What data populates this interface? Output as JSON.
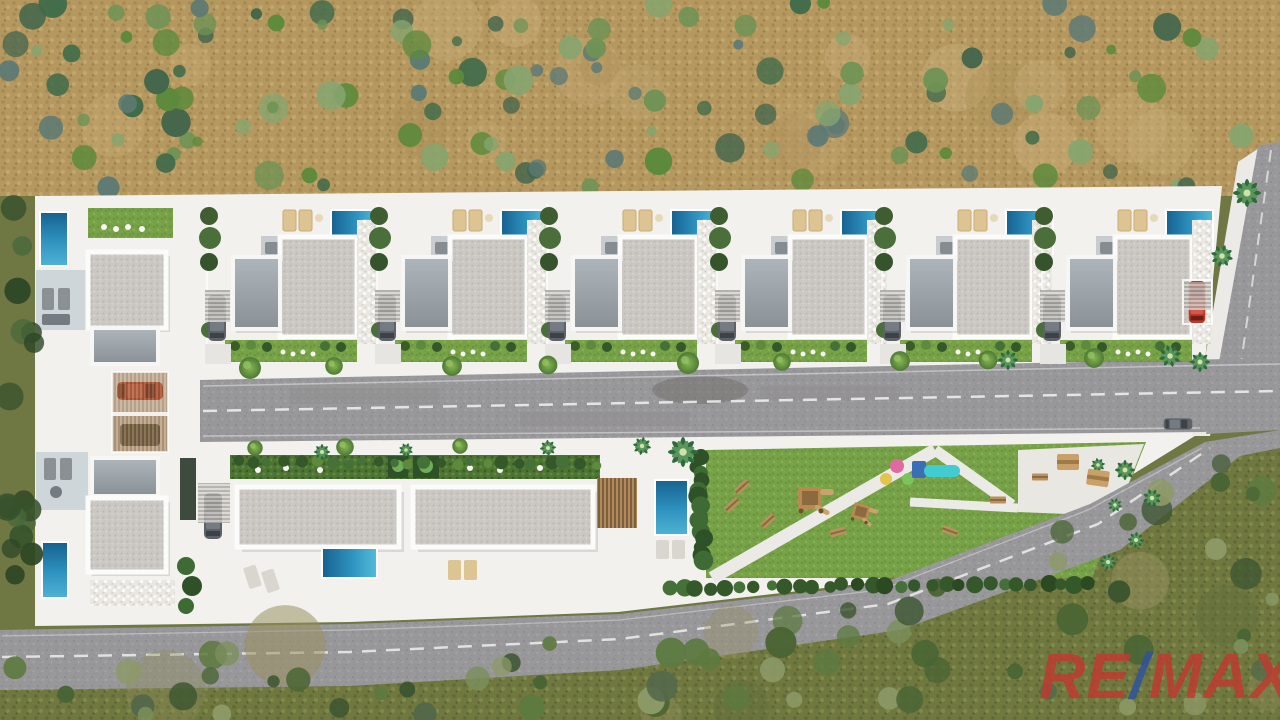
{
  "watermark": {
    "re": "RE",
    "slash": "/",
    "max": "MAX"
  },
  "palette": {
    "remax_red": "#c0392f",
    "remax_blue": "#2c53a0",
    "dry_field_tan": "#b4985f",
    "olive_scrub": "#6f7743",
    "platform_white": "#f2f1ee",
    "asphalt_grey": "#98979a",
    "pool_blue_deep": "#16618f",
    "pool_blue_light": "#55bcd9",
    "roof_speckle_grey": "#cbc8c3",
    "park_grass_green": "#76a147",
    "hedge_green": "#4d7433",
    "red_car": "#c0392b",
    "slide_cyan": "#41ccd1"
  },
  "scene": {
    "description": "Aerial 3D render of a gated villa development: two rows of white villas with private pools, central street, communal park with playground, surrounded by dry scrubland",
    "top_row_villas": {
      "count": 6,
      "x_positions": [
        205,
        375,
        545,
        715,
        880,
        1040
      ]
    },
    "left_column_villas": {
      "count": 2
    },
    "terraced_building_units": 2,
    "pools_count": 10,
    "roads": [
      "main-street",
      "east-perimeter-road",
      "south-perimeter-road"
    ],
    "park_features": [
      "lawn",
      "playground-tower",
      "slide",
      "play-balls",
      "benches",
      "picnic-tables",
      "palm-trees",
      "hedges"
    ]
  },
  "decor": {
    "road_bottom_edge": [
      [
        0,
        640
      ],
      [
        350,
        634
      ],
      [
        620,
        624
      ],
      [
        880,
        594
      ],
      [
        1090,
        514
      ],
      [
        1205,
        452
      ],
      [
        1280,
        440
      ]
    ],
    "scatter": [
      {
        "layer": "field-patches",
        "seed": 31,
        "x": 60,
        "y": 14,
        "w": 1120,
        "h": 156,
        "count": 20,
        "r": [
          18,
          36
        ],
        "palette": [
          "#c3a671",
          "#ab8f58",
          "#c9ad79"
        ],
        "op": [
          0.25,
          0.5
        ]
      },
      {
        "layer": "field-bushes",
        "seed": 11,
        "x": 0,
        "y": 2,
        "w": 1280,
        "h": 186,
        "count": 125,
        "r": [
          5,
          15
        ],
        "palette": [
          "#5c8a3c",
          "#86a56f",
          "#44664c",
          "#6e9355",
          "#5d7a74",
          "#3f6b4a"
        ]
      },
      {
        "layer": "scrub-patches",
        "seed": 37,
        "x": 0,
        "y": 440,
        "w": 1280,
        "h": 276,
        "count": 18,
        "r": [
          20,
          42
        ],
        "palette": [
          "#8d8a56",
          "#5f6e3b",
          "#97915f"
        ],
        "op": [
          0.3,
          0.55
        ],
        "below": true
      },
      {
        "layer": "scrub-bushes",
        "seed": 23,
        "x": 0,
        "y": 430,
        "w": 1280,
        "h": 286,
        "count": 160,
        "r": [
          6,
          16
        ],
        "palette": [
          "#4a6534",
          "#5d7a40",
          "#3c5530",
          "#7b8f5b",
          "#55684a",
          "#8d9a67"
        ],
        "below": true
      },
      {
        "layer": "west-trees",
        "seed": 5,
        "x": 6,
        "y": 200,
        "w": 30,
        "h": 418,
        "count": 17,
        "r": [
          8,
          14
        ],
        "palette": [
          "#37522c",
          "#48683a",
          "#2e4726"
        ]
      }
    ],
    "hedge_rows": [
      {
        "layer": "park-hedge",
        "seed": 41,
        "from": [
          668,
          588
        ],
        "to": [
          1090,
          583
        ],
        "n": 30,
        "r": [
          5,
          9
        ],
        "palette": [
          "#35582a",
          "#457038",
          "#2b4a22"
        ]
      },
      {
        "layer": "park-hedge",
        "seed": 43,
        "from": [
          698,
          458
        ],
        "to": [
          702,
          562
        ],
        "n": 14,
        "r": [
          6,
          10
        ],
        "palette": [
          "#2f5128",
          "#3e6a33"
        ]
      },
      {
        "layer": "park-hedge",
        "seed": 47,
        "from": [
          238,
          462
        ],
        "to": [
          596,
          464
        ],
        "n": 24,
        "r": [
          4,
          7
        ],
        "palette": [
          "#457038",
          "#35582a",
          "#5d8a3d"
        ]
      }
    ],
    "stamps": [
      {
        "layer": "road-trees",
        "symbol": "#tree-tpl",
        "points": [
          [
            250,
            368,
            1,
            0
          ],
          [
            334,
            366,
            0.8,
            0
          ],
          [
            452,
            366,
            0.9,
            0
          ],
          [
            548,
            365,
            0.85,
            0
          ],
          [
            688,
            363,
            1,
            0
          ],
          [
            782,
            362,
            0.8,
            0
          ],
          [
            900,
            361,
            0.9,
            0
          ],
          [
            988,
            360,
            0.85,
            0
          ],
          [
            1094,
            358,
            0.9,
            0
          ],
          [
            255,
            448,
            0.7,
            0
          ],
          [
            345,
            447,
            0.8,
            0
          ],
          [
            460,
            446,
            0.7,
            0
          ]
        ]
      },
      {
        "layer": "road-trees",
        "symbol": "#palm-tpl",
        "points": [
          [
            322,
            452,
            0.8,
            0
          ],
          [
            406,
            450,
            0.7,
            20
          ],
          [
            548,
            448,
            0.8,
            40
          ],
          [
            642,
            446,
            0.9,
            10
          ],
          [
            1008,
            360,
            1,
            0
          ],
          [
            1170,
            356,
            1.1,
            30
          ],
          [
            1222,
            256,
            1.1,
            15
          ],
          [
            1247,
            193,
            1.4,
            0
          ],
          [
            1200,
            362,
            1,
            45
          ],
          [
            683,
            452,
            1.5,
            0
          ]
        ]
      },
      {
        "layer": "park-palms",
        "symbol": "#palm-tpl",
        "points": [
          [
            1125,
            470,
            1,
            0
          ],
          [
            1152,
            498,
            0.9,
            25
          ],
          [
            1136,
            540,
            0.8,
            50
          ],
          [
            1108,
            562,
            0.8,
            10
          ],
          [
            1098,
            465,
            0.7,
            35
          ],
          [
            1115,
            505,
            0.7,
            60
          ]
        ]
      },
      {
        "layer": "park-items",
        "symbol": "#bench-tpl",
        "points": [
          [
            742,
            487,
            1,
            -42
          ],
          [
            768,
            521,
            1,
            -42
          ],
          [
            732,
            505,
            1,
            -42
          ],
          [
            838,
            532,
            1,
            -15
          ],
          [
            950,
            531,
            1,
            20
          ],
          [
            998,
            500,
            1,
            0
          ],
          [
            1040,
            477,
            1,
            0
          ]
        ]
      },
      {
        "layer": "park-items",
        "symbol": "#table-tpl",
        "points": [
          [
            1068,
            462,
            1,
            0
          ],
          [
            1098,
            478,
            1,
            8
          ]
        ]
      },
      {
        "layer": "park-items",
        "symbol": "#tower-tpl",
        "points": [
          [
            815,
            500,
            1,
            0
          ],
          [
            864,
            514,
            0.7,
            15
          ]
        ]
      }
    ]
  }
}
